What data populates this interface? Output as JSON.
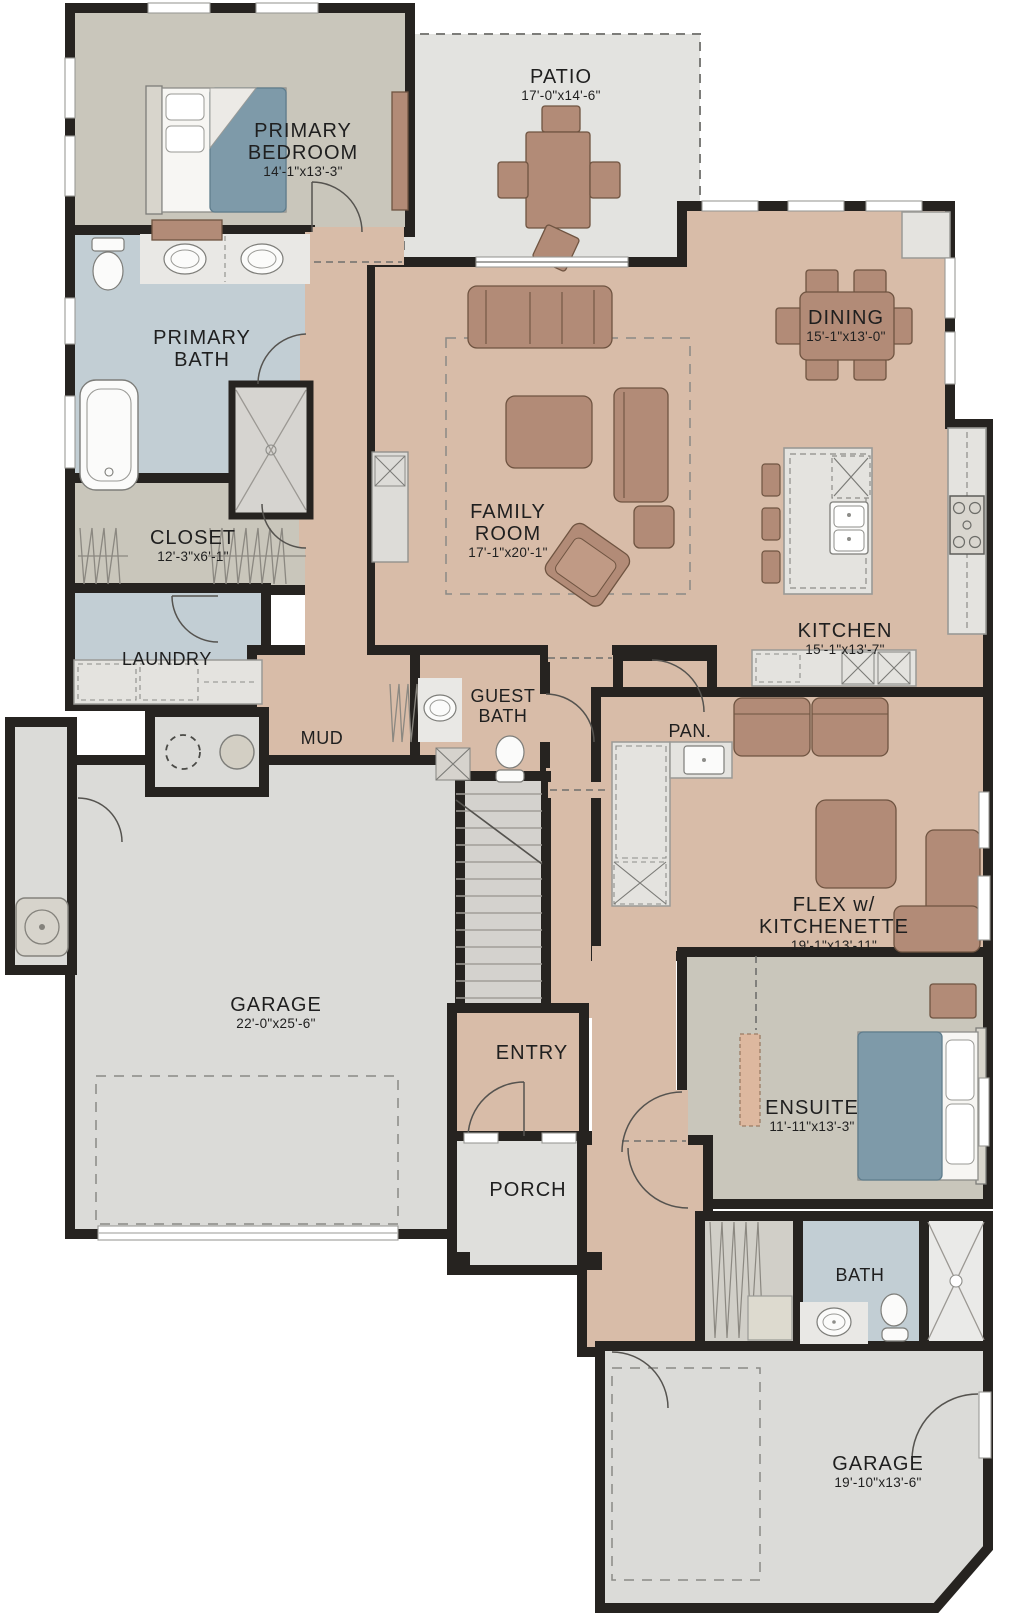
{
  "plan_title": "Floor Plan",
  "colors": {
    "wall": "#262320",
    "floor_tan": "#d8bca8",
    "floor_gray": "#dbdbd8",
    "floor_blue": "#c2ced4",
    "floor_beige": "#c9c6bb",
    "furniture_terracotta": "#b28b77",
    "bed_blue": "#7e9aa9"
  },
  "rooms": {
    "primary_bedroom": {
      "name": "PRIMARY BEDROOM",
      "dims": "14'-1\"x13'-3\""
    },
    "patio": {
      "name": "PATIO",
      "dims": "17'-0\"x14'-6\""
    },
    "dining": {
      "name": "DINING",
      "dims": "15'-1\"x13'-0\""
    },
    "primary_bath": {
      "name": "PRIMARY BATH"
    },
    "family_room": {
      "name": "FAMILY ROOM",
      "dims": "17'-1\"x20'-1\""
    },
    "kitchen": {
      "name": "KITCHEN",
      "dims": "15'-1\"x13'-7\""
    },
    "closet": {
      "name": "CLOSET",
      "dims": "12'-3\"x6'-1\""
    },
    "laundry": {
      "name": "LAUNDRY"
    },
    "mud": {
      "name": "MUD"
    },
    "guest_bath": {
      "name": "GUEST BATH"
    },
    "pantry": {
      "name": "PAN."
    },
    "flex": {
      "name": "FLEX w/ KITCHENETTE",
      "dims": "19'-1\"x13'-11\""
    },
    "garage_main": {
      "name": "GARAGE",
      "dims": "22'-0\"x25'-6\""
    },
    "entry": {
      "name": "ENTRY"
    },
    "ensuite": {
      "name": "ENSUITE",
      "dims": "11'-11\"x13'-3\""
    },
    "porch": {
      "name": "PORCH"
    },
    "bath": {
      "name": "BATH"
    },
    "garage_rear": {
      "name": "GARAGE",
      "dims": "19'-10\"x13'-6\""
    }
  }
}
